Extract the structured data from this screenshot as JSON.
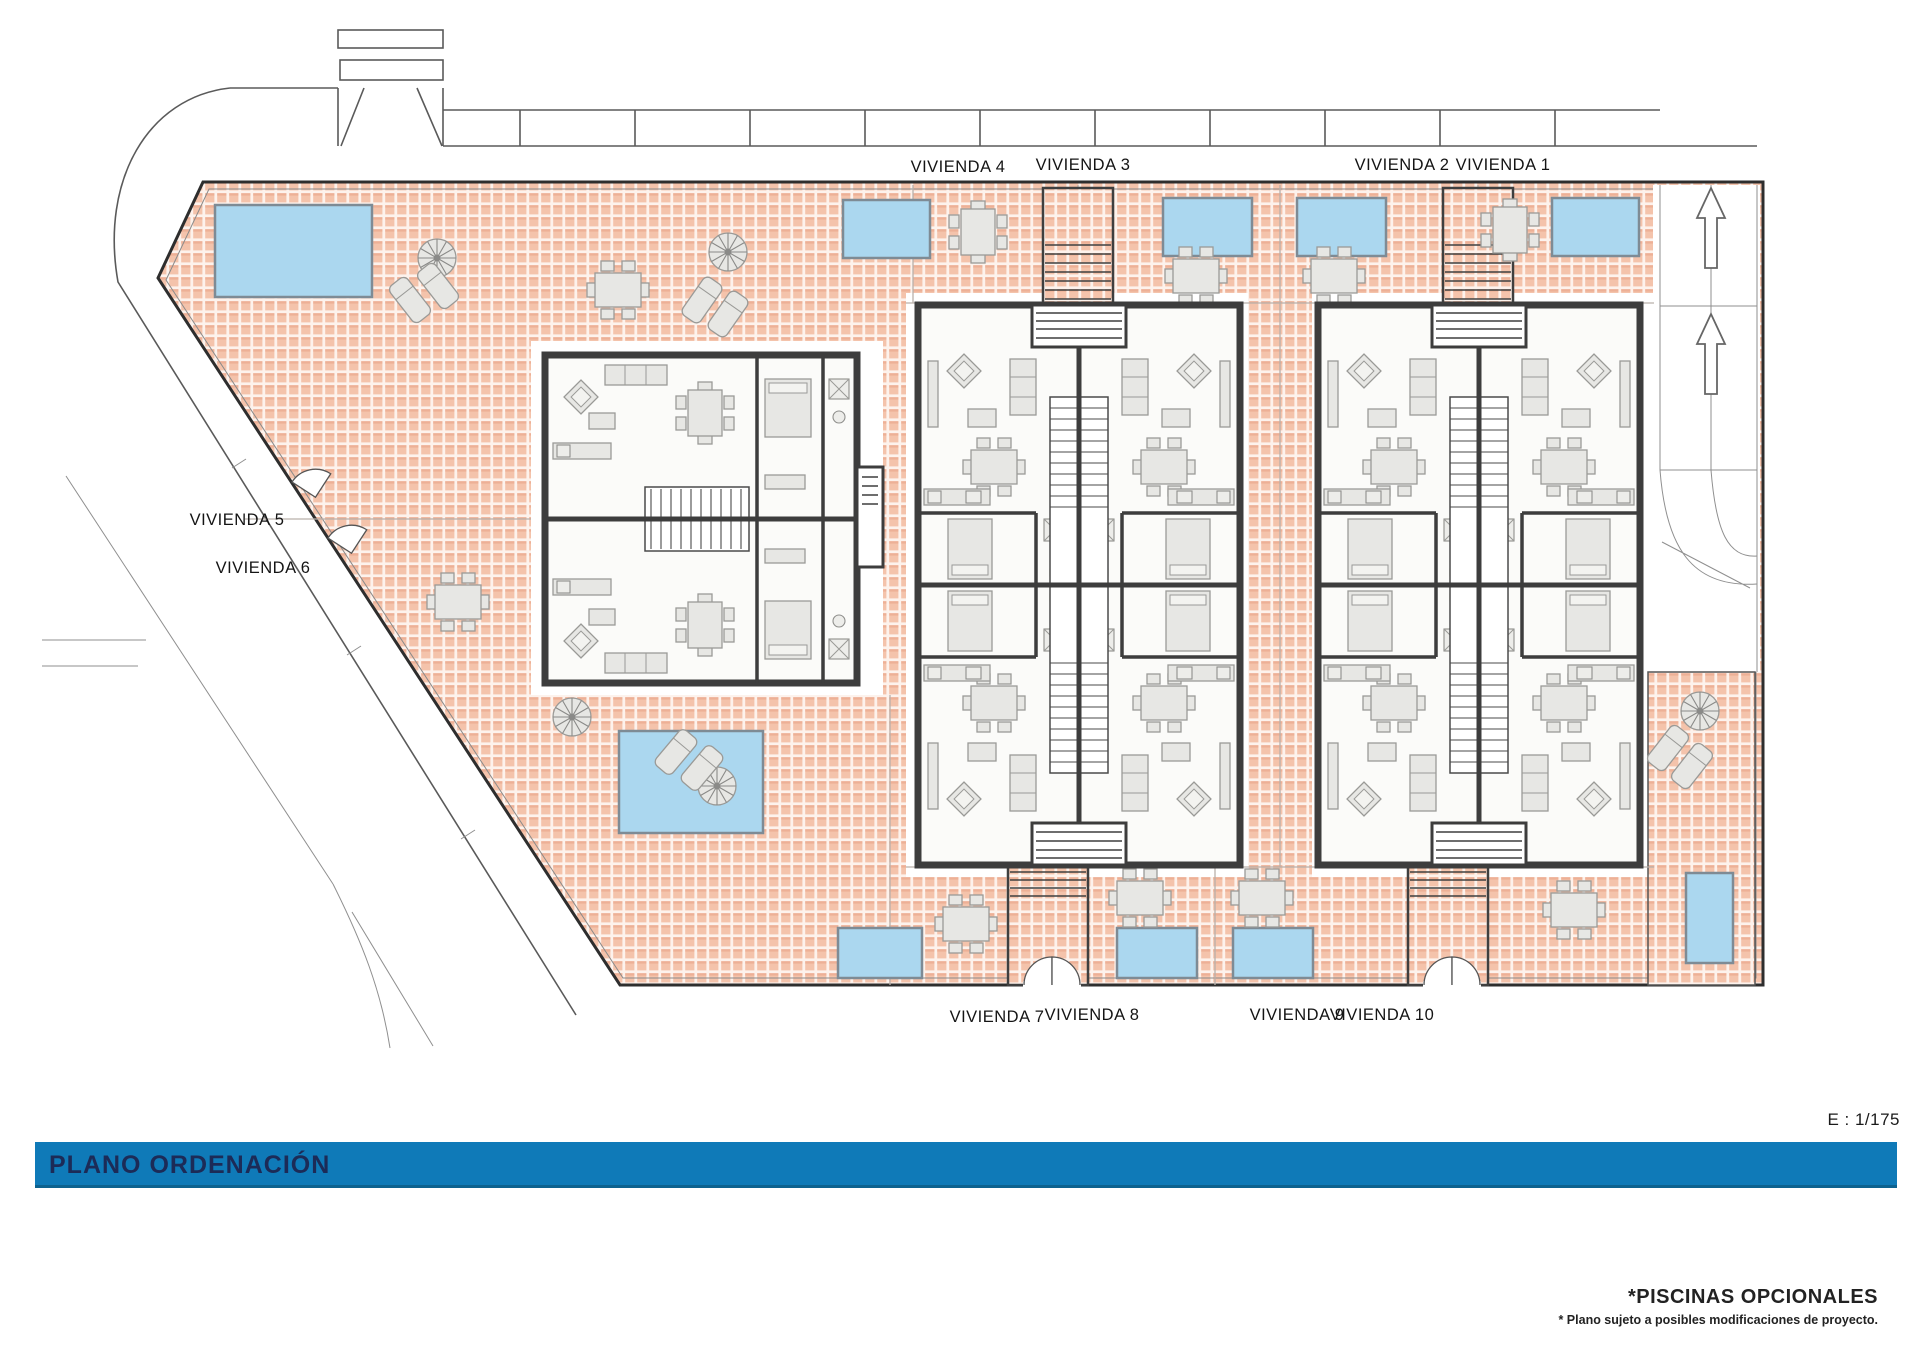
{
  "plan": {
    "title": "PLANO ORDENACIÓN",
    "scale_label": "E : 1/175",
    "footnote_primary": "*PISCINAS OPCIONALES",
    "footnote_secondary": "* Plano sujeto a posibles modificaciones de proyecto.",
    "labels": {
      "v1": "VIVIENDA 1",
      "v2": "VIVIENDA 2",
      "v3": "VIVIENDA 3",
      "v4": "VIVIENDA 4",
      "v5": "VIVIENDA 5",
      "v6": "VIVIENDA 6",
      "v7": "VIVIENDA 7",
      "v8": "VIVIENDA 8",
      "v9": "VIVIENDA 9",
      "v10": "VIVIENDA 10"
    }
  },
  "colors": {
    "title_bar": "#0f7ab8",
    "title_text": "#1c2b57",
    "terrace_bg": "#fdf2ec",
    "terrace_tile": "#f4c3ab",
    "terrace_tile_shadow": "#eaa98f",
    "pool_fill": "#abd7ef",
    "pool_stroke": "#7e8b95",
    "wall": "#3d3d3d",
    "furniture_fill": "#e7e7e4",
    "furniture_stroke": "#9a9a97"
  }
}
